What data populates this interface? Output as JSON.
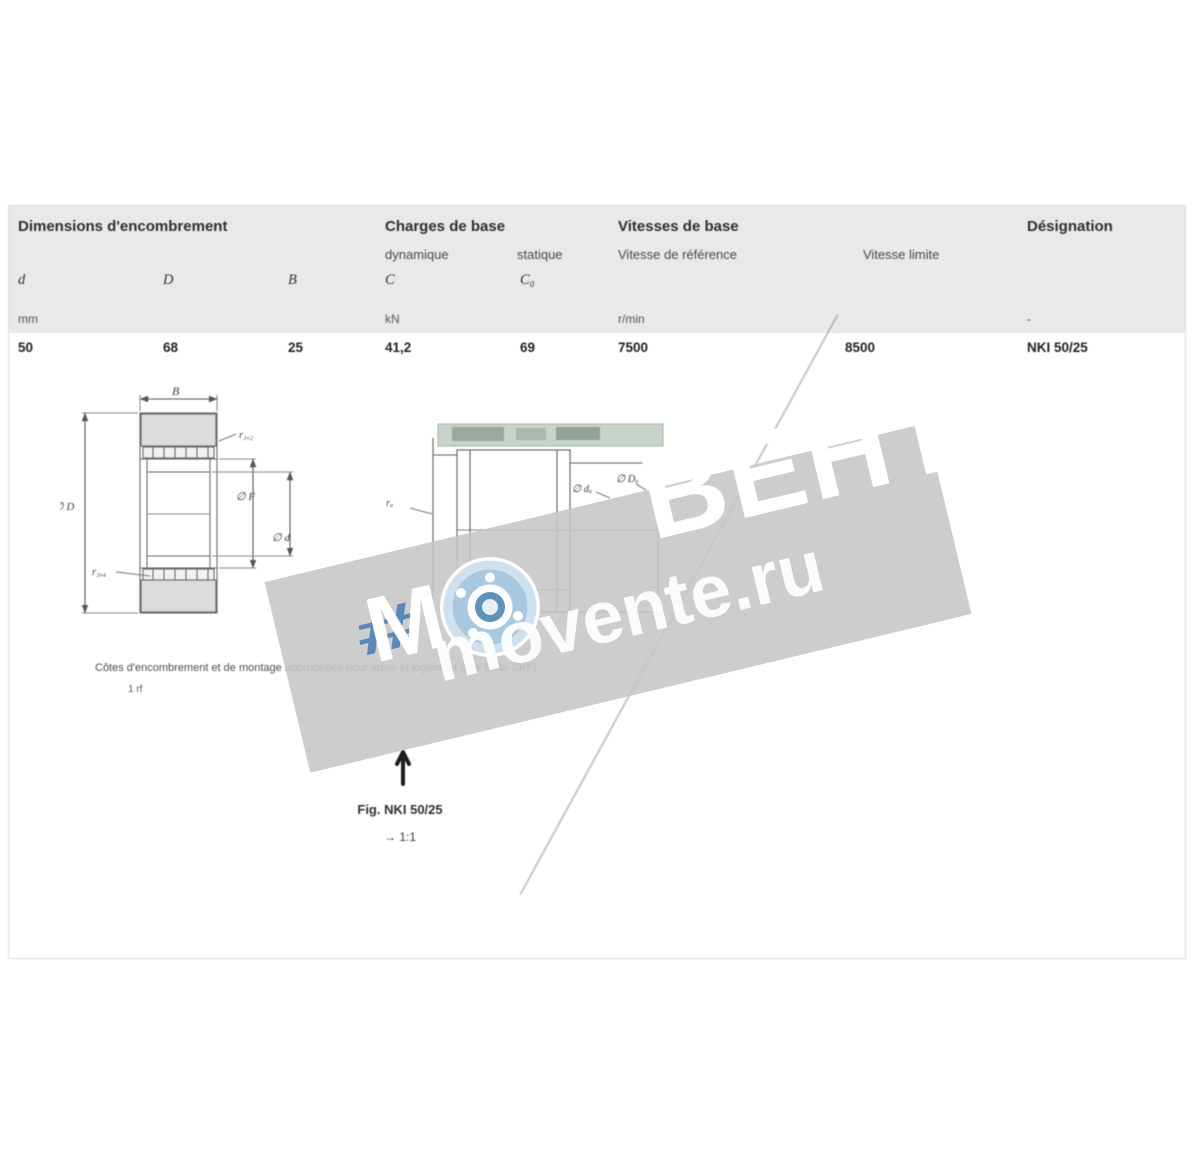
{
  "table": {
    "group1": "Dimensions d'encombrement",
    "group2": "Charges de base",
    "group2_sub1": "dynamique",
    "group2_sub2": "statique",
    "group3": "Vitesses de base",
    "group3_sub1": "Vitesse de référence",
    "group3_sub2": "Vitesse limite",
    "group4": "Désignation",
    "sym_d": "d",
    "sym_D": "D",
    "sym_B": "B",
    "sym_C": "C",
    "sym_C0": "C₀",
    "unit_mm": "mm",
    "unit_kn": "kN",
    "unit_speed": "r/min",
    "unit_dash": "-",
    "val_d": "50",
    "val_D": "68",
    "val_B": "25",
    "val_C": "41,2",
    "val_C0": "69",
    "val_ref_speed": "7500",
    "val_lim_speed": "8500",
    "val_designation": "NKI 50/25"
  },
  "drawing_left": {
    "dim_B": "B",
    "call_r12": "r₁,₂",
    "dim_D": "∅ D",
    "dim_F": "∅ F",
    "dim_d": "∅ d",
    "call_r34": "r₃,₄"
  },
  "drawing_right": {
    "call_ra": "rₐ",
    "dim_da": "∅ dₐ",
    "dim_Da": "∅ Dₐ"
  },
  "caption": {
    "line": "Côtes d'encombrement et de montage appropriées pour arbre et logement (voir texte SKF)",
    "footnote": "1 rf"
  },
  "note": {
    "line1": "Fig. NKI 50/25",
    "line2": "→ 1:1"
  },
  "watermark": {
    "letter_m": "М",
    "hash": "#",
    "brand": "ВЕНТ",
    "site": "movente.ru",
    "band_color": "#c6c6c6",
    "accent_blue": "#4b82b8",
    "bearing_blue": "#a7c8de"
  }
}
